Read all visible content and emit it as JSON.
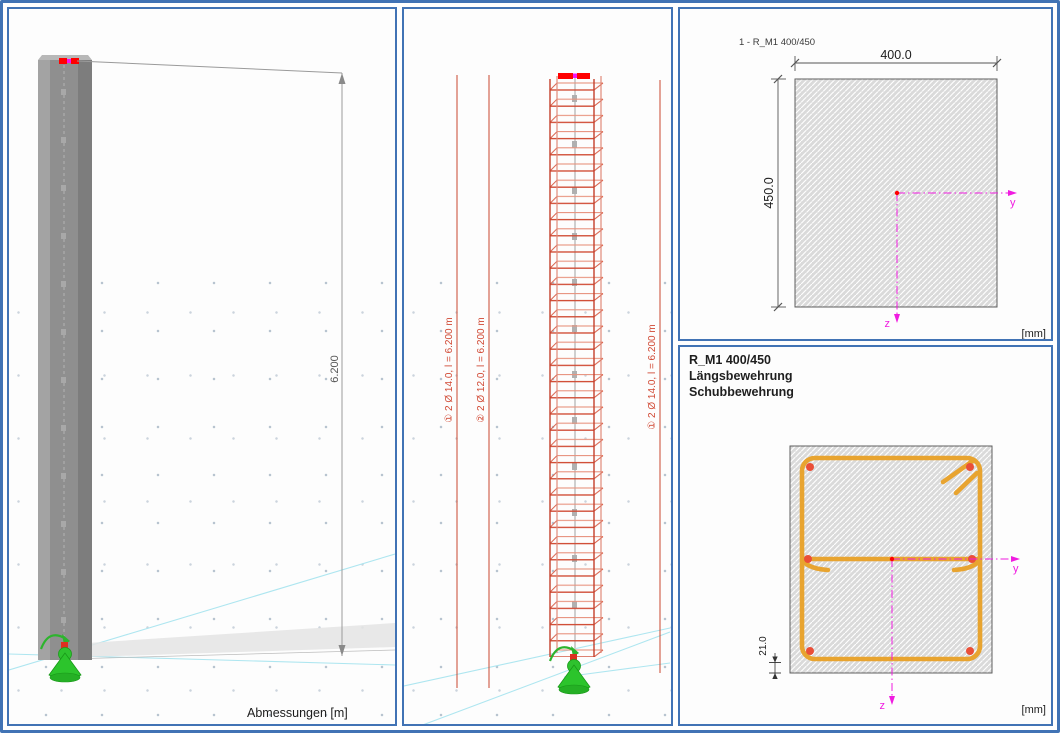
{
  "panel_abmessungen": {
    "caption": "Abmessungen [m]",
    "dim_height": "6.200"
  },
  "panel_bewehrung": {
    "ann_left": "① 2 Ø 14.0, l = 6.200 m",
    "ann_mid": "② 2 Ø 12.0, l = 6.200 m",
    "ann_right": "① 2 Ø 14.0, l = 6.200 m"
  },
  "panel_querschnitt": {
    "title": "1 - R_M1 400/450",
    "dim_width": "400.0",
    "dim_height": "450.0",
    "axis_y": "y",
    "axis_z": "z",
    "units": "[mm]"
  },
  "panel_bewehrung_qs": {
    "title": "R_M1 400/450",
    "line_laengs": "Längsbewehrung",
    "line_schub": "Schubbewehrung",
    "dim_cover": "21.0",
    "axis_y": "y",
    "axis_z": "z",
    "units": "[mm]"
  },
  "colors": {
    "frame_blue": "#4173b5",
    "rebar_red": "#d04a33",
    "stirrup_orange": "#e8a430",
    "axis_magenta": "#f01ce0",
    "node_red": "#ff0000",
    "support_green": "#2dbb2d",
    "concrete_gray": "#dadada",
    "grid_cyan": "#aee6f0"
  }
}
